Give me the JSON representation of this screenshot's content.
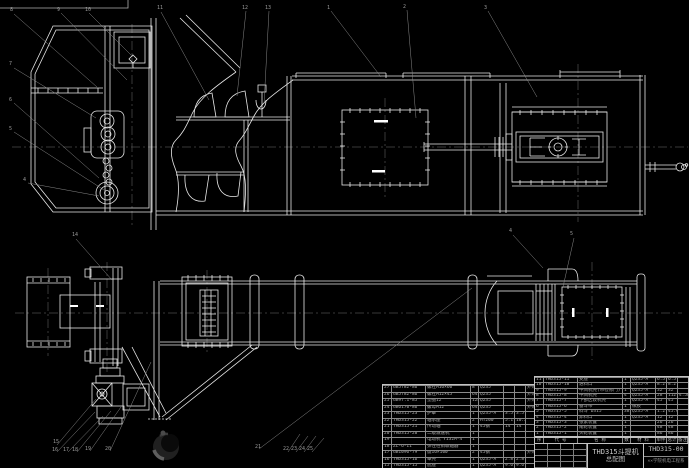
{
  "colors": {
    "background": "#000000",
    "line": "#e8e8e8",
    "leader": "#8a8a8a",
    "centerline": "#6f6f6f",
    "table_line": "#c2c2c2",
    "table_text": "#a9a9a9"
  },
  "title_block": {
    "drawing_title": "THD315斗提机",
    "drawing_subtitle": "总配图",
    "drawing_number": "THD315-00",
    "org": "××学院机电工程系"
  },
  "bom_right": {
    "headers": [
      "序",
      "代  号",
      "名  称",
      "数",
      "材  料",
      "单件",
      "总计",
      "备注"
    ],
    "rows": [
      {
        "seq": "11",
        "code": "THD315-11",
        "name": "支座",
        "qty": "1",
        "mat": "Q235-A",
        "w1": "6.5",
        "w2": "6.5",
        "rem": ""
      },
      {
        "seq": "10",
        "code": "THD315-10",
        "name": "进料口",
        "qty": "1",
        "mat": "Q235-A",
        "w1": "8.2",
        "w2": "8.2",
        "rem": ""
      },
      {
        "seq": "9",
        "code": "THD315-9",
        "name": "中间机壳(带检修门)",
        "qty": "1",
        "mat": "Q235-A",
        "w1": "32",
        "w2": "32",
        "rem": ""
      },
      {
        "seq": "8",
        "code": "THD315-8",
        "name": "中间机壳",
        "qty": "4",
        "mat": "Q235-A",
        "w1": "28",
        "w2": "112",
        "rem": "4.5M"
      },
      {
        "seq": "7",
        "code": "THD315-7",
        "name": "下部区段机壳",
        "qty": "1",
        "mat": "Q235-A",
        "w1": "45",
        "w2": "45",
        "rem": ""
      },
      {
        "seq": "6",
        "code": "THD315-6",
        "name": "畚斗带",
        "qty": "1",
        "mat": "橡胶",
        "w1": "",
        "w2": "",
        "rem": ""
      },
      {
        "seq": "5",
        "code": "THD315-5",
        "name": "料斗 D315",
        "qty": "38",
        "mat": "Q235-A",
        "w1": "1.2",
        "w2": "45.6",
        "rem": ""
      },
      {
        "seq": "4",
        "code": "THD315-4",
        "name": "卸料口",
        "qty": "1",
        "mat": "Q235-A",
        "w1": "12",
        "w2": "12",
        "rem": ""
      },
      {
        "seq": "3",
        "code": "THD315-3",
        "name": "张紧装置",
        "qty": "1",
        "mat": "",
        "w1": "26",
        "w2": "26",
        "rem": ""
      },
      {
        "seq": "2",
        "code": "THD315-2",
        "name": "尾轮装置",
        "qty": "1",
        "mat": "",
        "w1": "48",
        "w2": "48",
        "rem": ""
      },
      {
        "seq": "1",
        "code": "THD315-1",
        "name": "头轮装置",
        "qty": "1",
        "mat": "",
        "w1": "86",
        "w2": "86",
        "rem": ""
      }
    ]
  },
  "bom_left": {
    "rows": [
      {
        "seq": "27",
        "code": "GB5782-86",
        "name": "螺栓M16×60",
        "qty": "8",
        "mat": "Q235",
        "w1": "",
        "w2": "",
        "rem": "外购"
      },
      {
        "seq": "26",
        "code": "GB5782-86",
        "name": "螺栓M12×45",
        "qty": "64",
        "mat": "Q235",
        "w1": "",
        "w2": "",
        "rem": "外购"
      },
      {
        "seq": "25",
        "code": "GB97.1-85",
        "name": "垫圈12",
        "qty": "128",
        "mat": "Q235",
        "w1": "",
        "w2": "",
        "rem": "外购"
      },
      {
        "seq": "24",
        "code": "GB6170-86",
        "name": "螺母M12",
        "qty": "64",
        "mat": "Q235",
        "w1": "",
        "w2": "",
        "rem": "外购"
      },
      {
        "seq": "23",
        "code": "THD315-23",
        "name": "护罩",
        "qty": "1",
        "mat": "Q235-A",
        "w1": "3.5",
        "w2": "3.5",
        "rem": ""
      },
      {
        "seq": "22",
        "code": "THD315-22",
        "name": "轴承座",
        "qty": "2",
        "mat": "HT200",
        "w1": "5.1",
        "w2": "10.2",
        "rem": ""
      },
      {
        "seq": "21",
        "code": "THD315-21",
        "name": "传动轴",
        "qty": "1",
        "mat": "45钢",
        "w1": "14",
        "w2": "14",
        "rem": ""
      },
      {
        "seq": "20",
        "code": "THD315-20",
        "name": "二级减速机",
        "qty": "1",
        "mat": "",
        "w1": "",
        "w2": "",
        "rem": ""
      },
      {
        "seq": "19",
        "code": "",
        "name": "电动机 Y132M-4",
        "qty": "1",
        "mat": "",
        "w1": "",
        "w2": "",
        "rem": ""
      },
      {
        "seq": "18",
        "code": "ZL-6-II",
        "name": "弹性柱销联轴器",
        "qty": "1",
        "mat": "",
        "w1": "",
        "w2": "",
        "rem": ""
      },
      {
        "seq": "17",
        "code": "GB1096-79",
        "name": "键16×100",
        "qty": "2",
        "mat": "45钢",
        "w1": "",
        "w2": "",
        "rem": "外购"
      },
      {
        "seq": "16",
        "code": "THD315-16",
        "name": "罩壳",
        "qty": "1",
        "mat": "Q235-A",
        "w1": "2.8",
        "w2": "2.8",
        "rem": ""
      },
      {
        "seq": "15",
        "code": "THD315-15",
        "name": "底座",
        "qty": "1",
        "mat": "Q235-A",
        "w1": "9.6",
        "w2": "9.6",
        "rem": ""
      }
    ]
  },
  "balloons": [
    {
      "n": "8",
      "x": 10,
      "y": 8
    },
    {
      "n": "9",
      "x": 57,
      "y": 8
    },
    {
      "n": "10",
      "x": 85,
      "y": 8
    },
    {
      "n": "11",
      "x": 157,
      "y": 6
    },
    {
      "n": "12",
      "x": 242,
      "y": 6
    },
    {
      "n": "13",
      "x": 265,
      "y": 6
    },
    {
      "n": "1",
      "x": 327,
      "y": 6
    },
    {
      "n": "2",
      "x": 403,
      "y": 5
    },
    {
      "n": "3",
      "x": 484,
      "y": 6
    },
    {
      "n": "7",
      "x": 9,
      "y": 62
    },
    {
      "n": "6",
      "x": 9,
      "y": 98
    },
    {
      "n": "5",
      "x": 9,
      "y": 127
    },
    {
      "n": "4",
      "x": 23,
      "y": 178
    },
    {
      "n": "14",
      "x": 72,
      "y": 233
    },
    {
      "n": "4",
      "x": 509,
      "y": 229
    },
    {
      "n": "5",
      "x": 570,
      "y": 232
    },
    {
      "n": "15",
      "x": 53,
      "y": 440
    },
    {
      "n": "16",
      "x": 52,
      "y": 448
    },
    {
      "n": "17",
      "x": 63,
      "y": 448
    },
    {
      "n": "18",
      "x": 72,
      "y": 448
    },
    {
      "n": "19",
      "x": 85,
      "y": 447
    },
    {
      "n": "20",
      "x": 105,
      "y": 447
    },
    {
      "n": "21",
      "x": 255,
      "y": 445
    },
    {
      "n": "22",
      "x": 283,
      "y": 447
    },
    {
      "n": "23",
      "x": 291,
      "y": 447
    },
    {
      "n": "24",
      "x": 299,
      "y": 447
    },
    {
      "n": "25",
      "x": 307,
      "y": 447
    }
  ]
}
